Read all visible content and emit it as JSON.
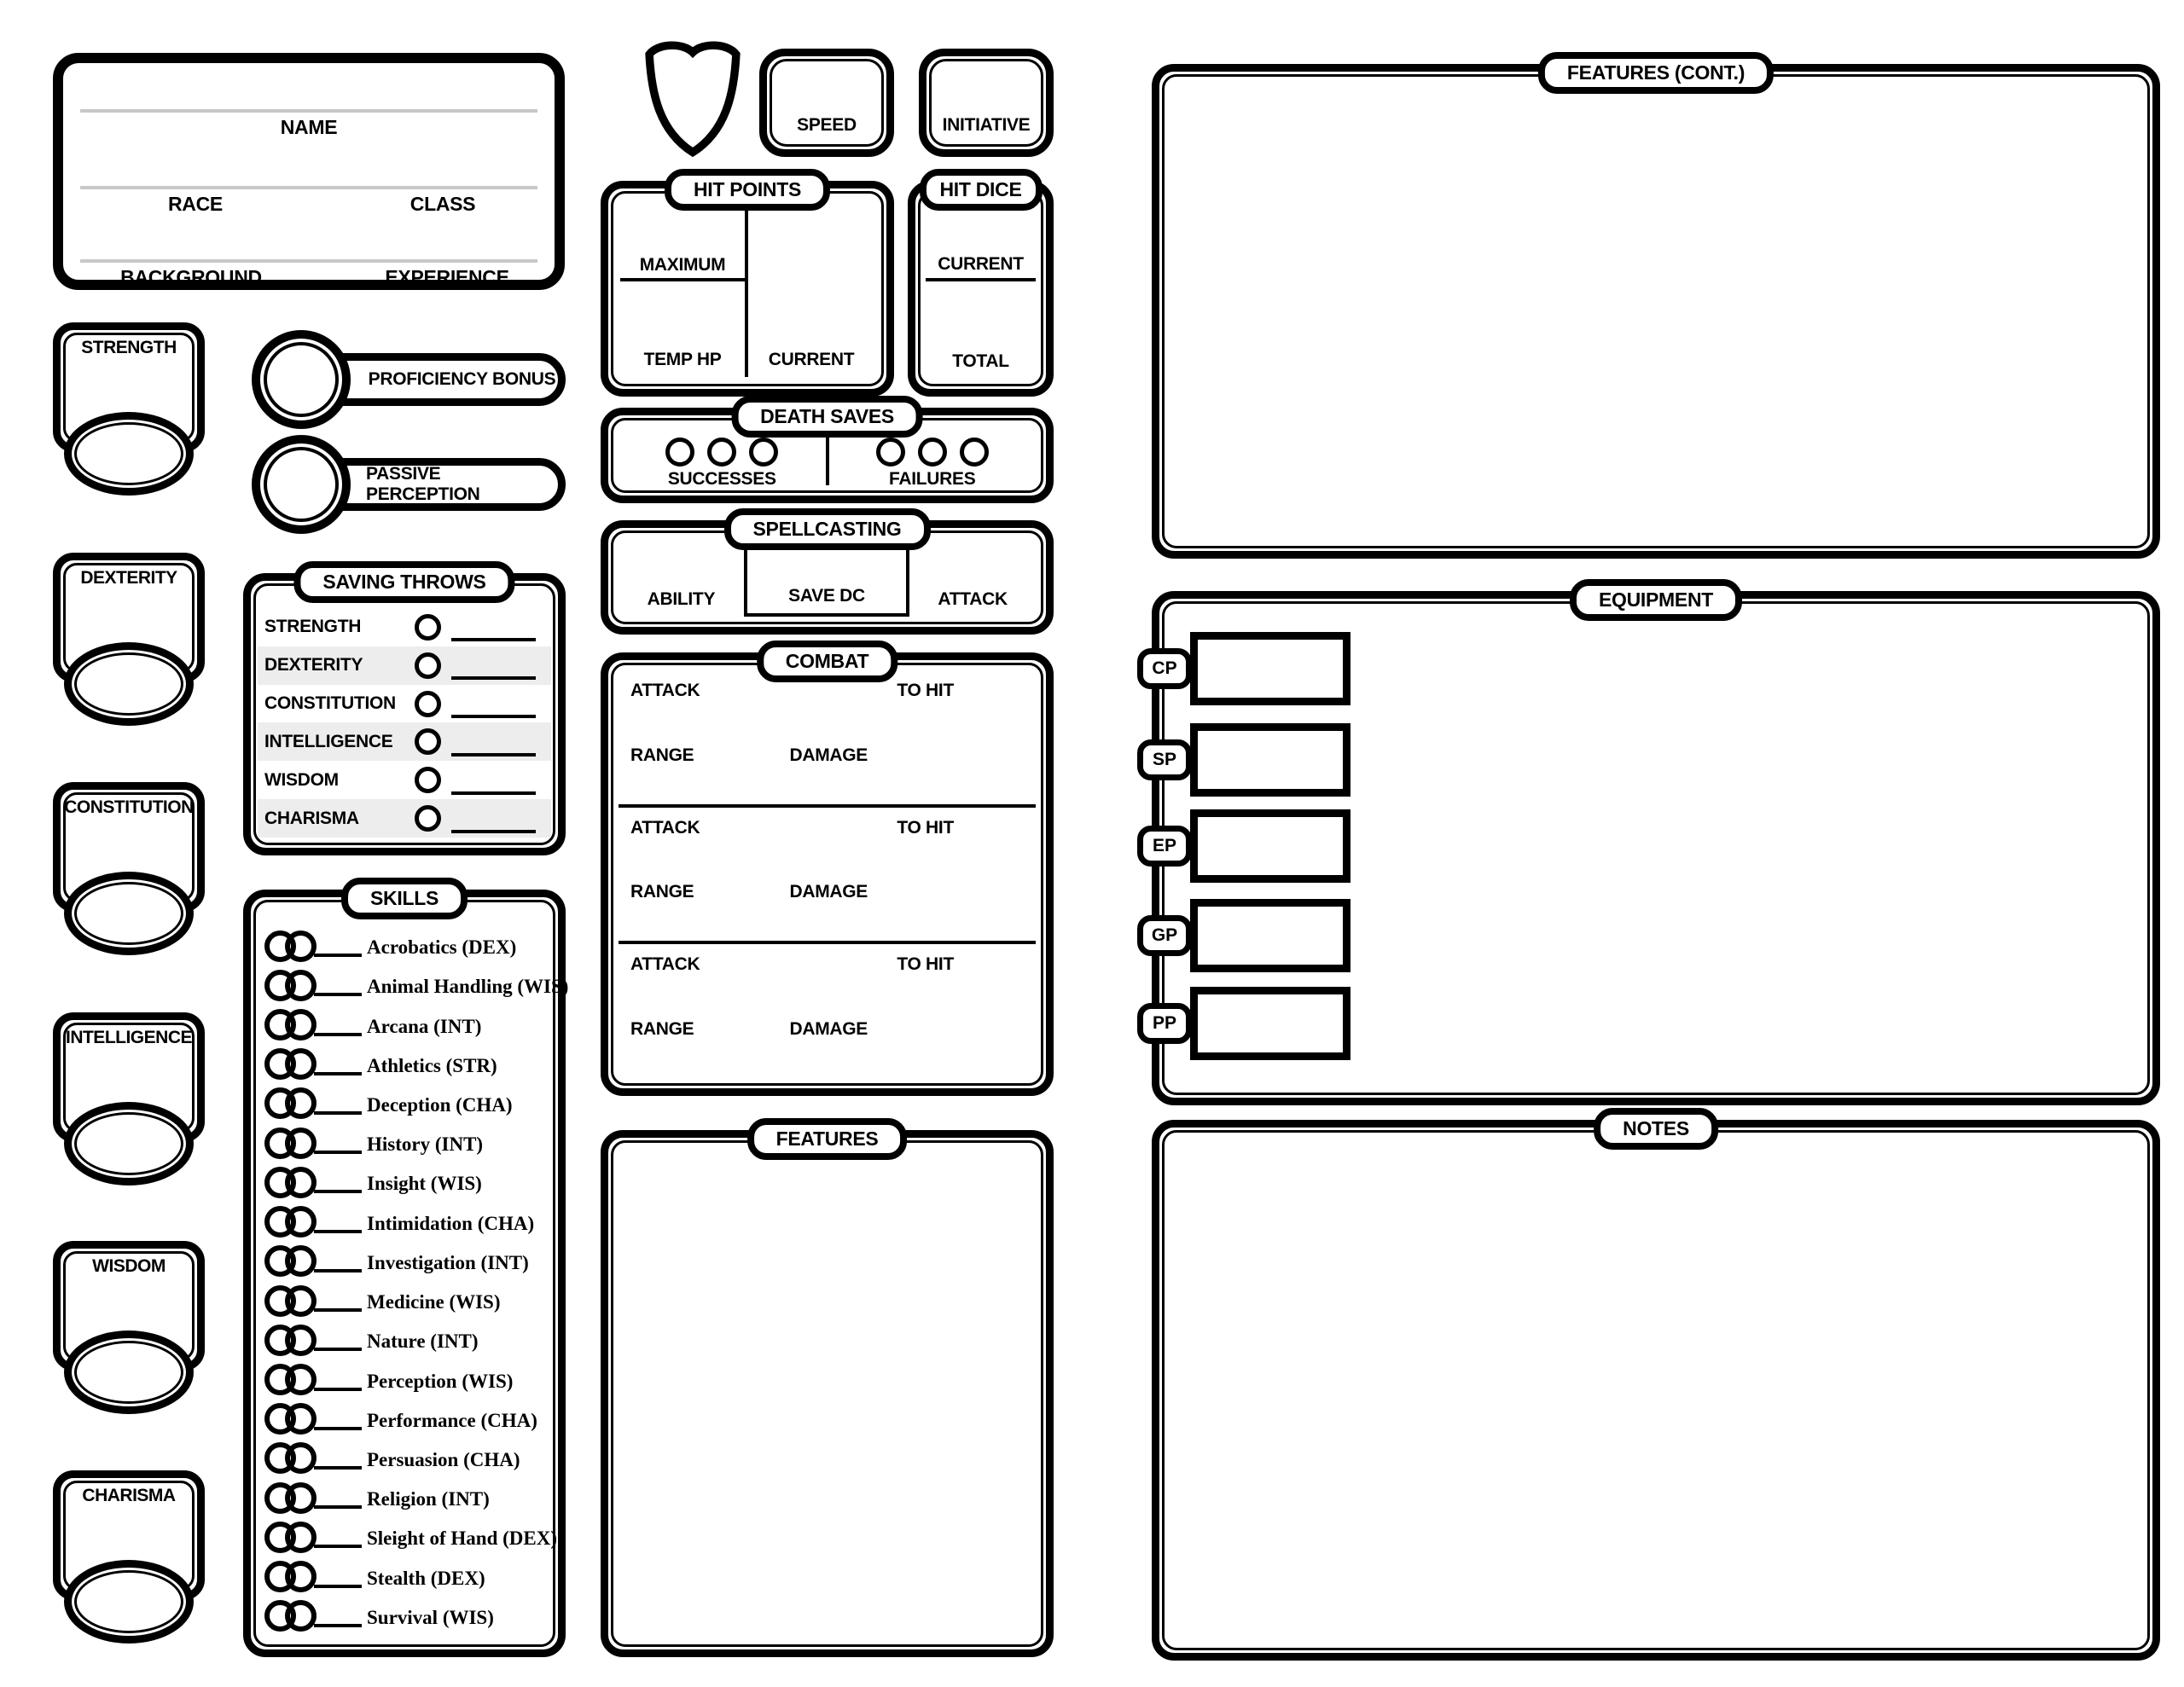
{
  "colors": {
    "ink": "#000000",
    "guide_line": "#c8c8c8",
    "row_stripe": "#ededed",
    "paper": "#ffffff"
  },
  "character_info": {
    "name_label": "NAME",
    "race_label": "RACE",
    "class_label": "CLASS",
    "background_label": "BACKGROUND",
    "experience_label": "EXPERIENCE"
  },
  "abilities": {
    "items": [
      "STRENGTH",
      "DEXTERITY",
      "CONSTITUTION",
      "INTELLIGENCE",
      "WISDOM",
      "CHARISMA"
    ]
  },
  "modifiers": {
    "proficiency_bonus": "PROFICIENCY BONUS",
    "passive_perception": "PASSIVE PERCEPTION"
  },
  "armor": {
    "icon": "shield-icon"
  },
  "speed": {
    "label": "SPEED"
  },
  "initiative": {
    "label": "INITIATIVE"
  },
  "hit_points": {
    "title": "HIT POINTS",
    "maximum_label": "MAXIMUM",
    "temp_hp_label": "TEMP HP",
    "current_label": "CURRENT"
  },
  "hit_dice": {
    "title": "HIT DICE",
    "current_label": "CURRENT",
    "total_label": "TOTAL"
  },
  "death_saves": {
    "title": "DEATH SAVES",
    "successes_label": "SUCCESSES",
    "failures_label": "FAILURES",
    "checkboxes_per_side": 3
  },
  "spellcasting": {
    "title": "SPELLCASTING",
    "ability_label": "ABILITY",
    "save_dc_label": "SAVE DC",
    "attack_label": "ATTACK"
  },
  "combat": {
    "title": "COMBAT",
    "sections": 3,
    "labels": {
      "attack": "ATTACK",
      "to_hit": "TO HIT",
      "range": "RANGE",
      "damage": "DAMAGE"
    }
  },
  "saving_throws": {
    "title": "SAVING THROWS",
    "rows": [
      "STRENGTH",
      "DEXTERITY",
      "CONSTITUTION",
      "INTELLIGENCE",
      "WISDOM",
      "CHARISMA"
    ]
  },
  "skills": {
    "title": "SKILLS",
    "items": [
      "Acrobatics (DEX)",
      "Animal Handling (WIS)",
      "Arcana (INT)",
      "Athletics (STR)",
      "Deception (CHA)",
      "History (INT)",
      "Insight (WIS)",
      "Intimidation (CHA)",
      "Investigation (INT)",
      "Medicine (WIS)",
      "Nature (INT)",
      "Perception (WIS)",
      "Performance (CHA)",
      "Persuasion (CHA)",
      "Religion (INT)",
      "Sleight of Hand (DEX)",
      "Stealth (DEX)",
      "Survival (WIS)"
    ]
  },
  "features": {
    "title": "FEATURES"
  },
  "features_cont": {
    "title": "FEATURES (CONT.)"
  },
  "equipment": {
    "title": "EQUIPMENT",
    "coins": [
      "CP",
      "SP",
      "EP",
      "GP",
      "PP"
    ]
  },
  "notes": {
    "title": "NOTES"
  }
}
